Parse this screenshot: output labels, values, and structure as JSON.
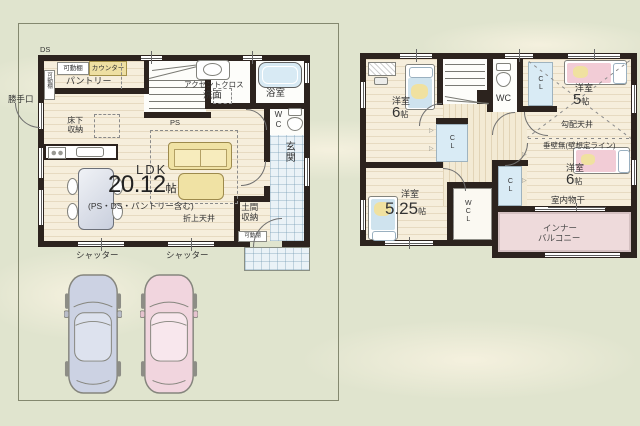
{
  "common": {
    "room": "洋室",
    "jo": "帖",
    "cl": "CL",
    "wc": "WC",
    "shutter": "シャッター",
    "movable_shelf": "可動棚"
  },
  "floor1": {
    "ds": "DS",
    "ps": "PS",
    "counter": "カウンター",
    "pantry": "パントリー",
    "back_door": "勝手口",
    "underfloor_storage": "床下収納",
    "accent_cross": "アクセントクロス",
    "washroom": "洗面",
    "bathroom": "浴室",
    "coffered_ceiling": "折上天井",
    "doma_storage": "土間収納",
    "entrance": "玄関",
    "ldk": {
      "name": "LDK",
      "size": "20.12",
      "note": "(PS・DS・パントリー含む)"
    }
  },
  "floor2": {
    "sizes": {
      "nw": "6",
      "ne": "5",
      "e": "6",
      "sw": "5.25"
    },
    "wcl": "WCL",
    "sloped_ceiling": "勾配天井",
    "no_hanging_wall": "垂壁無(壁想定ライン)",
    "indoor_drying": "室内物干",
    "balcony_line1": "インナー",
    "balcony_line2": "バルコニー"
  },
  "colors": {
    "background": "#e0e4ce",
    "wall": "#2c231e",
    "wood_floor": "#f6eedc",
    "tile_blue": "#eaf2f7",
    "closet_blue": "#d9ebf5",
    "sofa_yellow": "#f0e2a4",
    "balcony_pink": "#eedadb",
    "car_blue": "#ccd2e3",
    "car_pink": "#f1d5de"
  }
}
